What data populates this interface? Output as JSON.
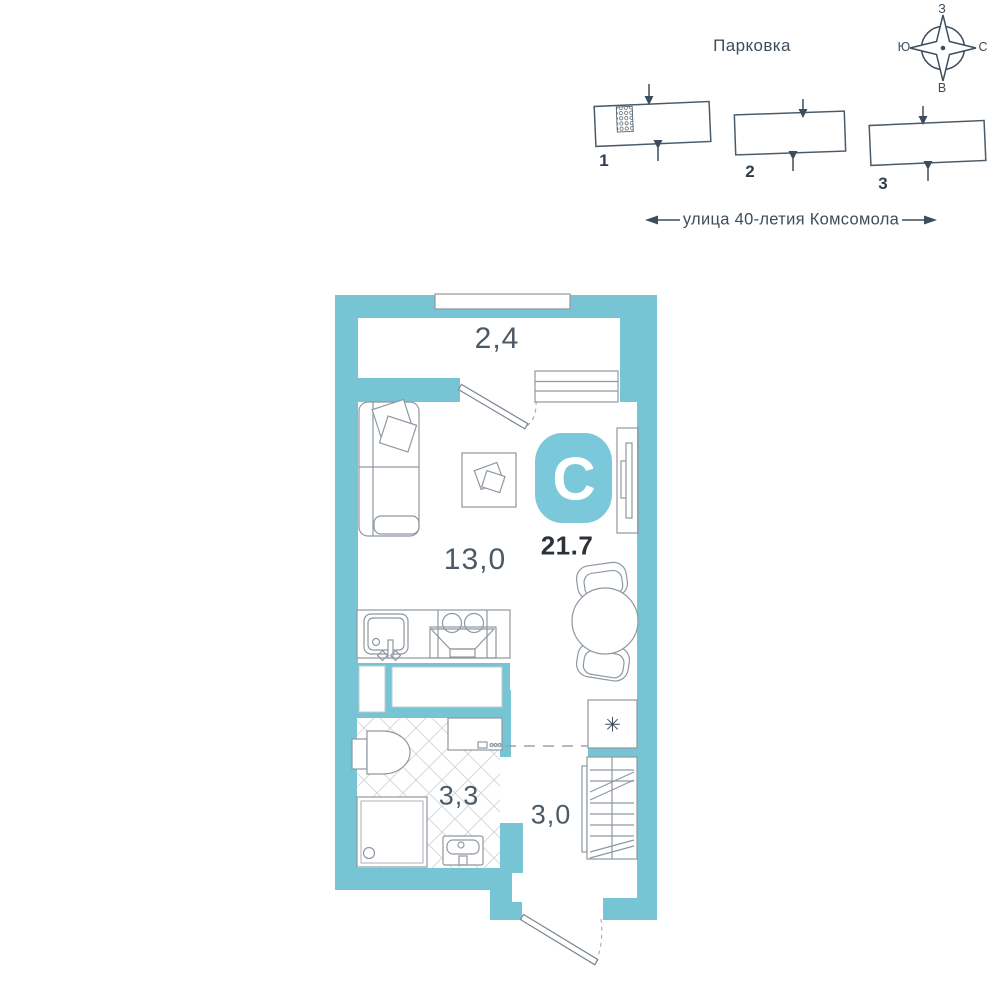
{
  "colors": {
    "wall_teal": "#77C5D4",
    "logo_teal": "#7BC8DA",
    "outline_dark": "#3E4D5C",
    "furniture_gray": "#8F98A1",
    "hatch_gray": "#D6DADD",
    "area_text": "#4D5A66",
    "total_area_text": "#2B323A"
  },
  "site_plan": {
    "title": "Парковка",
    "street_label": "улица 40-летия Комсомола",
    "compass": {
      "top": "З",
      "left": "Ю",
      "right": "С",
      "bottom": "В"
    },
    "parking_lots": [
      {
        "number": "1"
      },
      {
        "number": "2"
      },
      {
        "number": "3"
      }
    ]
  },
  "floor_plan": {
    "logo_letter": "С",
    "total_area": "21.7",
    "rooms": {
      "balcony": {
        "area": "2,4"
      },
      "living_room": {
        "area": "13,0"
      },
      "bathroom": {
        "area": "3,3"
      },
      "hallway": {
        "area": "3,0"
      }
    },
    "fridge_symbol": "✳"
  }
}
